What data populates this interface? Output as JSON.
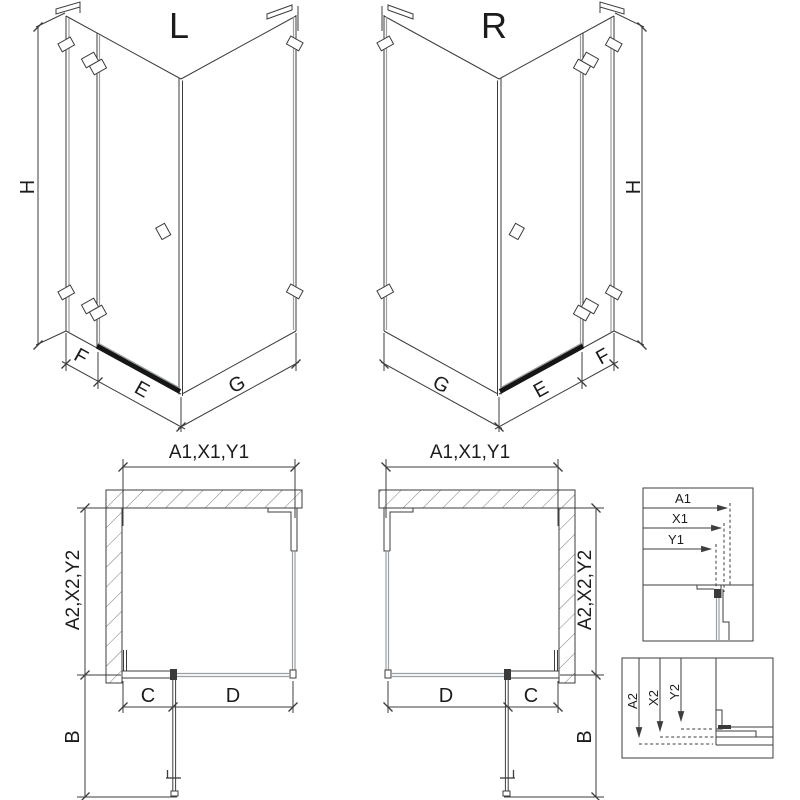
{
  "palette": {
    "line": "#3d3d3d",
    "glass": "#9aa0a3",
    "threshold": "#161616",
    "hatch": "#7a7a7a",
    "background": "#ffffff"
  },
  "iso_left": {
    "title": "L",
    "dims": {
      "height": "H",
      "fixed_width": "F",
      "door_width": "E",
      "side_width": "G"
    }
  },
  "iso_right": {
    "title": "R",
    "dims": {
      "height": "H",
      "fixed_width": "F",
      "door_width": "E",
      "side_width": "G"
    }
  },
  "plan_left": {
    "width_dim": "A1,X1,Y1",
    "depth_dim": "A2,X2,Y2",
    "fixed_dim": "C",
    "door_dim": "D",
    "swing_dim": "B"
  },
  "plan_right": {
    "width_dim": "A1,X1,Y1",
    "depth_dim": "A2,X2,Y2",
    "fixed_dim": "C",
    "door_dim": "D",
    "swing_dim": "B"
  },
  "detail_width": {
    "labels": [
      "A1",
      "X1",
      "Y1"
    ]
  },
  "detail_depth": {
    "labels": [
      "A2",
      "X2",
      "Y2"
    ]
  }
}
